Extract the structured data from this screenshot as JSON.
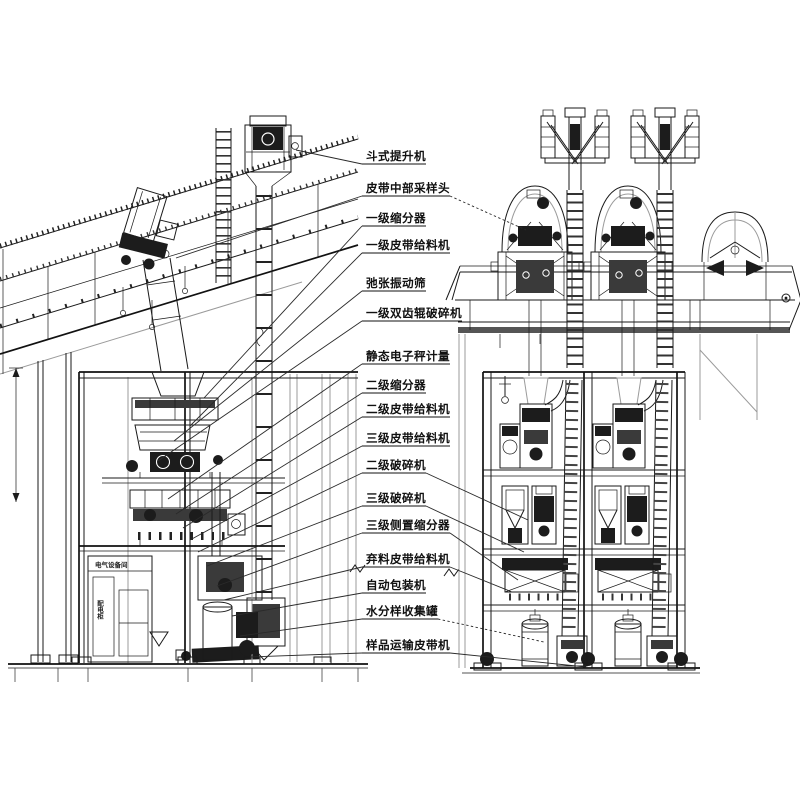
{
  "figure": {
    "background": "#ffffff",
    "line_color": "#1a1a1a",
    "secondary_line_color": "#9b9b9b",
    "views": {
      "left": "side-elevation",
      "right": "front-elevation"
    }
  },
  "labels": [
    {
      "text": "斗式提升机"
    },
    {
      "text": "皮带中部采样头"
    },
    {
      "text": "一级缩分器"
    },
    {
      "text": "一级皮带给料机"
    },
    {
      "text": "弛张振动筛"
    },
    {
      "text": "一级双齿辊破碎机"
    },
    {
      "text": "静态电子秤计量"
    },
    {
      "text": "二级缩分器"
    },
    {
      "text": "二级皮带给料机"
    },
    {
      "text": "三级皮带给料机"
    },
    {
      "text": "二级破碎机"
    },
    {
      "text": "三级破碎机"
    },
    {
      "text": "三级侧置缩分器"
    },
    {
      "text": "弃料皮带给料机"
    },
    {
      "text": "自动包装机"
    },
    {
      "text": "水分样收集罐"
    },
    {
      "text": "样品运输皮带机"
    }
  ],
  "cabinet": {
    "room_label": "电气设备间",
    "panel_label": "配电柜"
  }
}
